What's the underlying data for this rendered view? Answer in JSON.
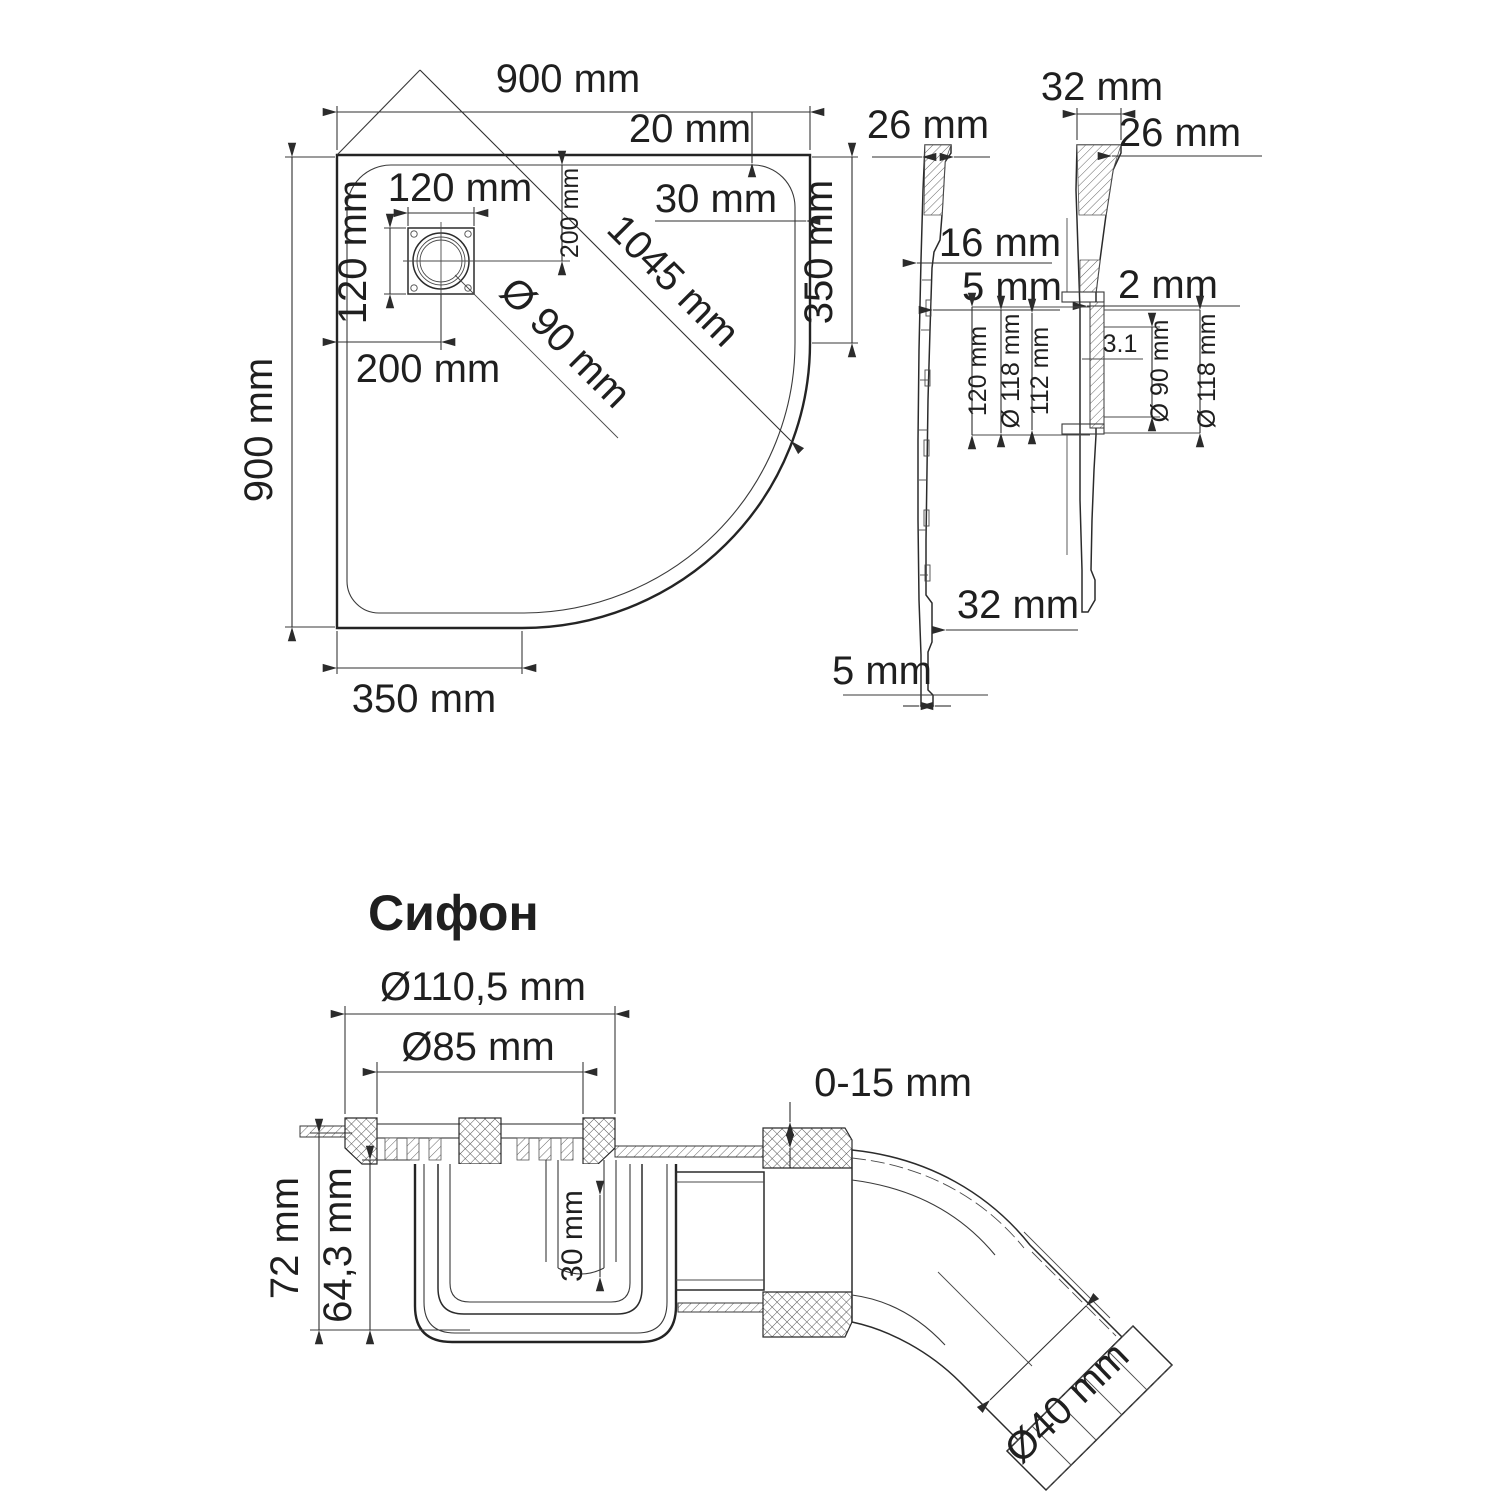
{
  "accent": {
    "heading_color": "#2e3d66",
    "line_color": "#2b2b2b"
  },
  "plan_view": {
    "width_top": "900 mm",
    "inset_top": "20 mm",
    "inset_right": "30 mm",
    "drain_width": "120 mm",
    "drain_height": "120 mm",
    "drain_offset_top": "200 mm",
    "diagonal": "1045 mm",
    "drain_diameter": "Ø 90 mm",
    "drain_offset_left": "200 mm",
    "height_left": "900 mm",
    "straight_right": "350 mm",
    "straight_bottom": "350 mm"
  },
  "side_view_plain": {
    "top_thickness": "26 mm",
    "step": "16 mm",
    "wall": "5 mm",
    "bottom_width": "32 mm",
    "bottom_thickness": "5 mm"
  },
  "side_view_drain": {
    "top_width": "32 mm",
    "top_edge": "26 mm",
    "wall": "2 mm",
    "detail": {
      "d120": "120 mm",
      "d118_left": "Ø 118 mm",
      "d112": "112 mm",
      "d31": "3.1",
      "d90": "Ø 90 mm",
      "d118_right": "Ø 118 mm"
    }
  },
  "siphon": {
    "heading": "Сифон",
    "flange_outer": "Ø110,5 mm",
    "flange_inner": "Ø85 mm",
    "adjust": "0-15 mm",
    "height_total": "72 mm",
    "height_body": "64,3 mm",
    "water_seal": "30 mm",
    "outlet": "Ø40 mm"
  }
}
